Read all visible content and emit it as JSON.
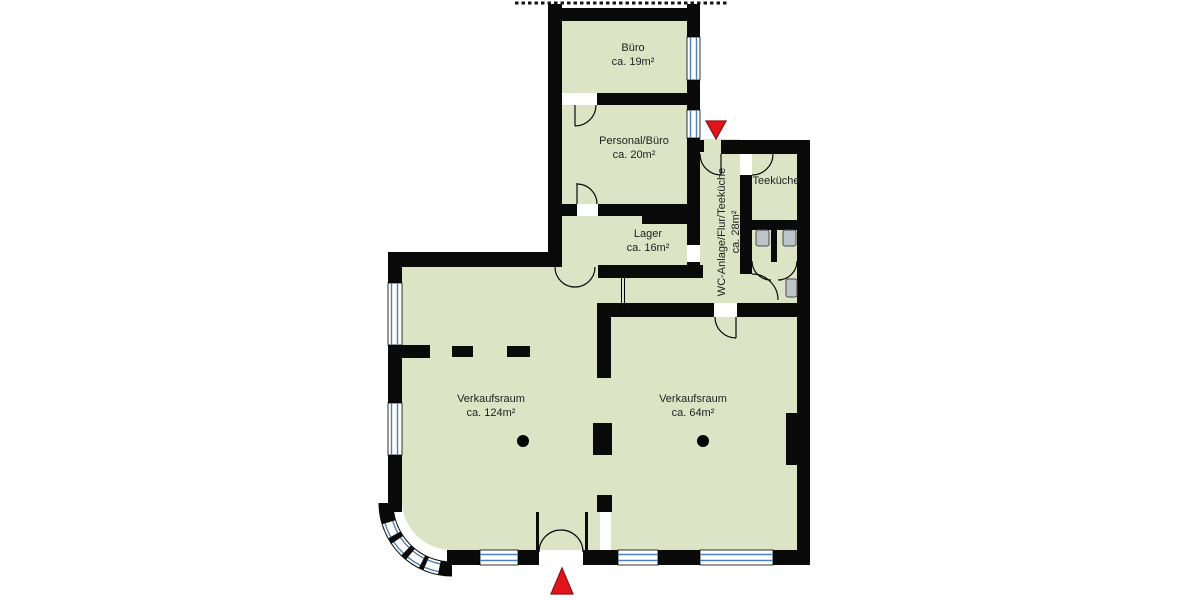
{
  "plan": {
    "type": "floor-plan",
    "rooms": [
      {
        "name": "Büro",
        "area": "ca. 19m²"
      },
      {
        "name": "Personal/Büro",
        "area": "ca. 20m²"
      },
      {
        "name": "Lager",
        "area": "ca. 16m²"
      },
      {
        "name": "WC-Anlage/Flur/Teeküche",
        "area": "ca. 28m²"
      },
      {
        "name": "Teeküche"
      },
      {
        "name": "Verkaufsraum",
        "area": "ca. 124m²"
      },
      {
        "name": "Verkaufsraum",
        "area": "ca. 64m²"
      }
    ],
    "markers": [
      {
        "label": "entrance-arrow",
        "direction": "down"
      },
      {
        "label": "entrance-arrow",
        "direction": "up"
      }
    ],
    "fixtures": [
      "toilet",
      "toilet",
      "washbasin"
    ]
  },
  "colors": {
    "floor": "#dde4c5",
    "wall": "#0a0a0a",
    "window": "#4f80b4",
    "marker": "#e2141c",
    "fixture": "#bcc3c9",
    "text": "#1f1f1f"
  }
}
